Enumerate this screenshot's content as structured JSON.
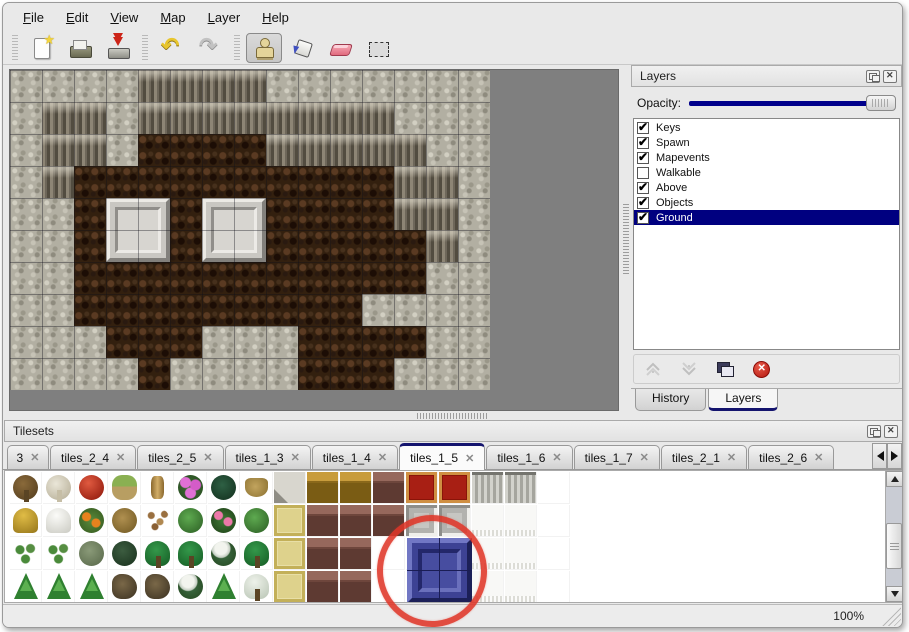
{
  "colors": {
    "selection_navy": "#000080",
    "accent_navy": "#14146e",
    "annotation_red": "#df3628",
    "canvas_gray": "#7f7f7f"
  },
  "menu_bar": {
    "items": [
      {
        "label": "File"
      },
      {
        "label": "Edit"
      },
      {
        "label": "View"
      },
      {
        "label": "Map"
      },
      {
        "label": "Layer"
      },
      {
        "label": "Help"
      }
    ]
  },
  "toolbar": {
    "groups": [
      {
        "buttons": [
          {
            "name": "new",
            "icon": "new-file-icon",
            "selected": false
          },
          {
            "name": "open",
            "icon": "open-folder-icon",
            "selected": false
          },
          {
            "name": "save",
            "icon": "save-icon",
            "selected": false
          }
        ]
      },
      {
        "buttons": [
          {
            "name": "undo",
            "icon": "undo-arrow-icon",
            "selected": false
          },
          {
            "name": "redo",
            "icon": "redo-arrow-icon",
            "selected": false
          }
        ]
      },
      {
        "buttons": [
          {
            "name": "stamp",
            "icon": "stamp-tool-icon",
            "selected": true
          },
          {
            "name": "fill",
            "icon": "paint-bucket-icon",
            "selected": false
          },
          {
            "name": "eraser",
            "icon": "eraser-icon",
            "selected": false
          },
          {
            "name": "select",
            "icon": "selection-rect-icon",
            "selected": false
          }
        ]
      }
    ]
  },
  "map_view": {
    "tile_size": 32,
    "legend": {
      "L": "light-rock",
      "C": "cliff-face",
      "G": "brown-ground"
    },
    "grid": [
      "LLLLCCCCLLLLLLL",
      "LCCLCCCCCCCCLLL",
      "LCCLGGGGCCCCCLL",
      "LCGGGGGGGGGGCCL",
      "LLGGGGGGGGGGCCL",
      "LLGGGGGGGGGGGCL",
      "LLGGGGGGGGGGGLL",
      "LLGGGGGGGGGLLLL",
      "LLLGGGLLLGGGGLL",
      "LLLLGLLLLGGGLLL"
    ],
    "beveled_blocks": [
      {
        "col": 3,
        "row": 4
      },
      {
        "col": 6,
        "row": 4
      }
    ]
  },
  "layers_panel": {
    "title": "Layers",
    "opacity": {
      "label": "Opacity:",
      "value_fraction": 1
    },
    "layers": [
      {
        "name": "Keys",
        "checked": true,
        "selected": false
      },
      {
        "name": "Spawn",
        "checked": true,
        "selected": false
      },
      {
        "name": "Mapevents",
        "checked": true,
        "selected": false
      },
      {
        "name": "Walkable",
        "checked": false,
        "selected": false
      },
      {
        "name": "Above",
        "checked": true,
        "selected": false
      },
      {
        "name": "Objects",
        "checked": true,
        "selected": false
      },
      {
        "name": "Ground",
        "checked": true,
        "selected": true
      }
    ],
    "buttons": [
      {
        "name": "raise-layer",
        "icon": "chevron-up-icon",
        "enabled": false
      },
      {
        "name": "lower-layer",
        "icon": "chevron-down-icon",
        "enabled": false
      },
      {
        "name": "duplicate-layer",
        "icon": "duplicate-icon",
        "enabled": true
      },
      {
        "name": "delete-layer",
        "icon": "delete-icon",
        "enabled": true
      }
    ],
    "dock_tabs": [
      {
        "label": "History",
        "active": false
      },
      {
        "label": "Layers",
        "active": true
      }
    ]
  },
  "tilesets_panel": {
    "title": "Tilesets",
    "close_glyph": "✕",
    "tabs": [
      {
        "label": "3",
        "active": false,
        "truncated": true
      },
      {
        "label": "tiles_2_4",
        "active": false
      },
      {
        "label": "tiles_2_5",
        "active": false
      },
      {
        "label": "tiles_1_3",
        "active": false
      },
      {
        "label": "tiles_1_4",
        "active": false
      },
      {
        "label": "tiles_1_5",
        "active": true
      },
      {
        "label": "tiles_1_6",
        "active": false
      },
      {
        "label": "tiles_1_7",
        "active": false
      },
      {
        "label": "tiles_2_1",
        "active": false
      },
      {
        "label": "tiles_2_6",
        "active": false
      }
    ],
    "tile_legend": {
      "t1": "bare-tree",
      "t2": "dead-tree",
      "fr": "red-flower",
      "st": "stump",
      "tr": "trunk",
      "fp": "pink-flowers",
      "fe": "fern",
      "dg": "dry-grass",
      "sn": "stone-tile",
      "w1": "gold-wood",
      "w2": "brown-wood",
      "cp": "red-carpet",
      "cg": "gray-curtain",
      "cw": "white-curtain",
      "fg": "gray-frames",
      "ha": "hay-mound",
      "sm": "snow-mound",
      "fo": "orange-flowers",
      "bd": "dry-bush",
      "lv": "leaves",
      "lp": "lily-pad",
      "ro": "rose-bush",
      "sp": "sprouts",
      "bg": "gray-bush",
      "bk": "dark-bush",
      "pm": "palm-tree",
      "sw": "snow-tree",
      "cf": "conifer",
      "tw": "twisted-tree",
      "sl": "snow-palm",
      "mt": "mat",
      "em": "empty",
      "bl": "blue-tile-part"
    },
    "tile_grid": [
      [
        "t1",
        "t2",
        "fr",
        "st",
        "tr",
        "fp",
        "fe",
        "dg",
        "sn",
        "w1",
        "w1",
        "w2",
        "cp",
        "cp",
        "cg",
        "cg",
        "em"
      ],
      [
        "ha",
        "sm",
        "fo",
        "bd",
        "lv",
        "lp",
        "ro",
        "lp",
        "mt",
        "w2",
        "w2",
        "w2",
        "fg",
        "fg",
        "cw",
        "cw",
        "em"
      ],
      [
        "sp",
        "sp",
        "bg",
        "bk",
        "pm",
        "pm",
        "sw",
        "pm",
        "mt",
        "w2",
        "w2",
        "em",
        "bl",
        "bl",
        "cw",
        "cw",
        "em"
      ],
      [
        "cf",
        "cf",
        "cf",
        "tw",
        "tw",
        "sw",
        "cf",
        "sl",
        "mt",
        "w2",
        "w2",
        "em",
        "bl",
        "bl",
        "cw",
        "cw",
        "em"
      ]
    ],
    "annotation": {
      "shape": "red-circle",
      "target": "blue-tile"
    }
  },
  "status_bar": {
    "zoom_level": "100%"
  }
}
